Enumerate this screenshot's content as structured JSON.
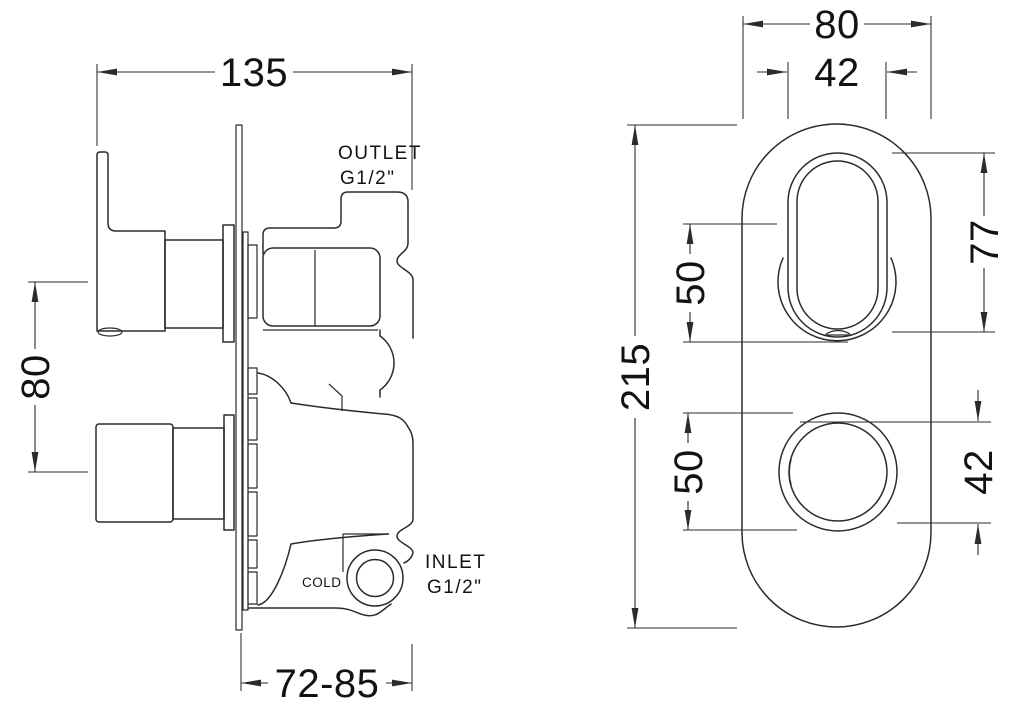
{
  "page": {
    "background": "#ffffff",
    "line_color": "#2b2b2b",
    "text_color": "#121212"
  },
  "side_view": {
    "dim_width": "135",
    "dim_handle_spacing": "80",
    "dim_depth_range": "72-85",
    "label_outlet": "OUTLET",
    "label_outlet_thread": "G1/2\"",
    "label_inlet": "INLET",
    "label_inlet_thread": "G1/2\"",
    "label_cold": "COLD"
  },
  "front_view": {
    "dim_plate_width": "80",
    "dim_slot_width": "42",
    "dim_plate_height": "215",
    "dim_upper_offset": "50",
    "dim_lower_offset": "50",
    "dim_slot_height": "77",
    "dim_knob_diameter": "42"
  }
}
